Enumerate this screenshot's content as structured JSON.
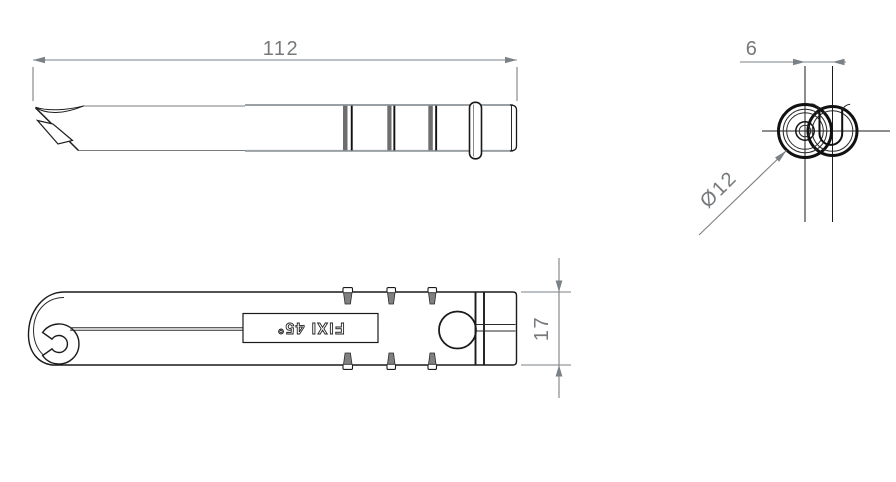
{
  "drawing": {
    "type": "technical-drawing",
    "dimensions": {
      "length": {
        "value": "112"
      },
      "spacing": {
        "value": "6"
      },
      "diameter": {
        "value": "Ø12"
      },
      "height": {
        "value": "17"
      }
    },
    "marking": {
      "text": "FIXI 45°"
    },
    "colors": {
      "background": "#ffffff",
      "outline": "#1a1a1a",
      "edge_gray": "#9aa0a3",
      "dimension": "#7b8287",
      "rib_fill": "#808080"
    }
  }
}
